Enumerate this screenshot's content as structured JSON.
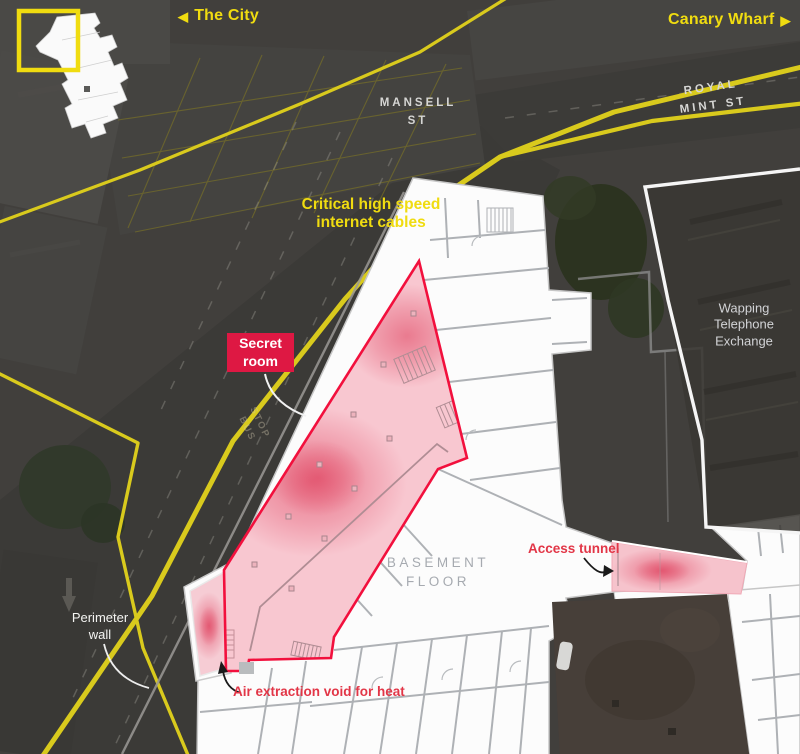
{
  "nav": {
    "left": {
      "arrow": "◀",
      "label": "The City"
    },
    "right": {
      "label": "Canary Wharf",
      "arrow": "▶"
    }
  },
  "streets": {
    "mansell": "MANSELL\nST",
    "royal_mint": "ROYAL MINT ST"
  },
  "buildings": {
    "wapping_exchange": "Wapping\nTelephone\nExchange",
    "basement_floor": "BASEMENT\nFLOOR"
  },
  "annotations": {
    "cables_label": "Critical high speed\ninternet cables",
    "secret_room": "Secret\nroom",
    "access_tunnel": "Access tunnel",
    "air_extraction": "Air extraction void for heat",
    "perimeter_wall": "Perimeter\nwall"
  },
  "road_markings": {
    "bus_stop": "STOP\nBUS"
  },
  "legend_colors": {
    "internet_cables_yellow": "#d9ca1d",
    "label_yellow": "#f0dc10",
    "secret_room_fill": "#f8c7d0",
    "secret_room_outline": "#f2103d",
    "badge_red": "#de1843",
    "annotation_red": "#e23647",
    "floorplan_white": "#fcfcfc",
    "floorplan_wall_gray": "#aeb1b5",
    "aerial_background": "#413f3c"
  }
}
